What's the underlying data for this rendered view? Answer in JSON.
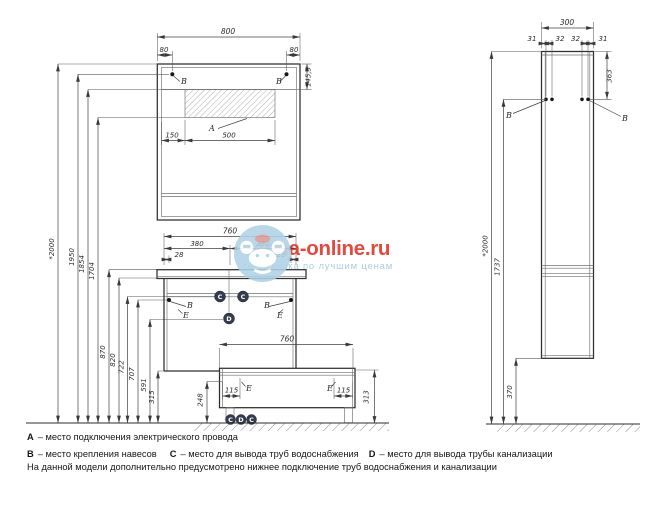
{
  "watermark": {
    "site": "vanna-online.ru",
    "tagline": "сантехника по лучшим ценам"
  },
  "markers": {
    "a": "A",
    "b": "B",
    "c": "C",
    "d": "D",
    "e": "E"
  },
  "dims": {
    "mirror_width": "800",
    "mirror_hinge_left": "80",
    "mirror_hinge_right": "80",
    "mirror_top_height": "145,5",
    "mirror_zone_offset": "150",
    "mirror_zone_width": "500",
    "h_total": "*2000",
    "h_1950": "1950",
    "h_1854": "1854",
    "h_1704": "1704",
    "h_870": "870",
    "h_820": "820",
    "h_722": "722",
    "h_707": "707",
    "h_591": "591",
    "h_315": "315",
    "vanity_width": "760",
    "vanity_left_half": "380",
    "vanity_right_half": "380",
    "vanity_inset_left": "28",
    "vanity_inset_right": "28",
    "base_width": "760",
    "base_edge_left": "115",
    "base_edge_right": "115",
    "base_248": "248",
    "base_313": "313",
    "col_depth": "300",
    "col_31_left": "31",
    "col_32_left": "32",
    "col_32_right": "32",
    "col_31_right": "31",
    "col_363": "363",
    "col_total": "*2000",
    "col_1737": "1737",
    "col_370": "370"
  },
  "legend": {
    "items": [
      {
        "key": "A",
        "text": "– место подключения электрического провода"
      },
      {
        "key": "B",
        "text": "– место крепления навесов"
      },
      {
        "key": "C",
        "text": "– место для вывода труб водоснабжения"
      },
      {
        "key": "D",
        "text": "– место для вывода трубы канализации"
      }
    ],
    "note": "На данной модели дополнительно предусмотрено нижнее подключение труб водоснабжения и канализации"
  }
}
